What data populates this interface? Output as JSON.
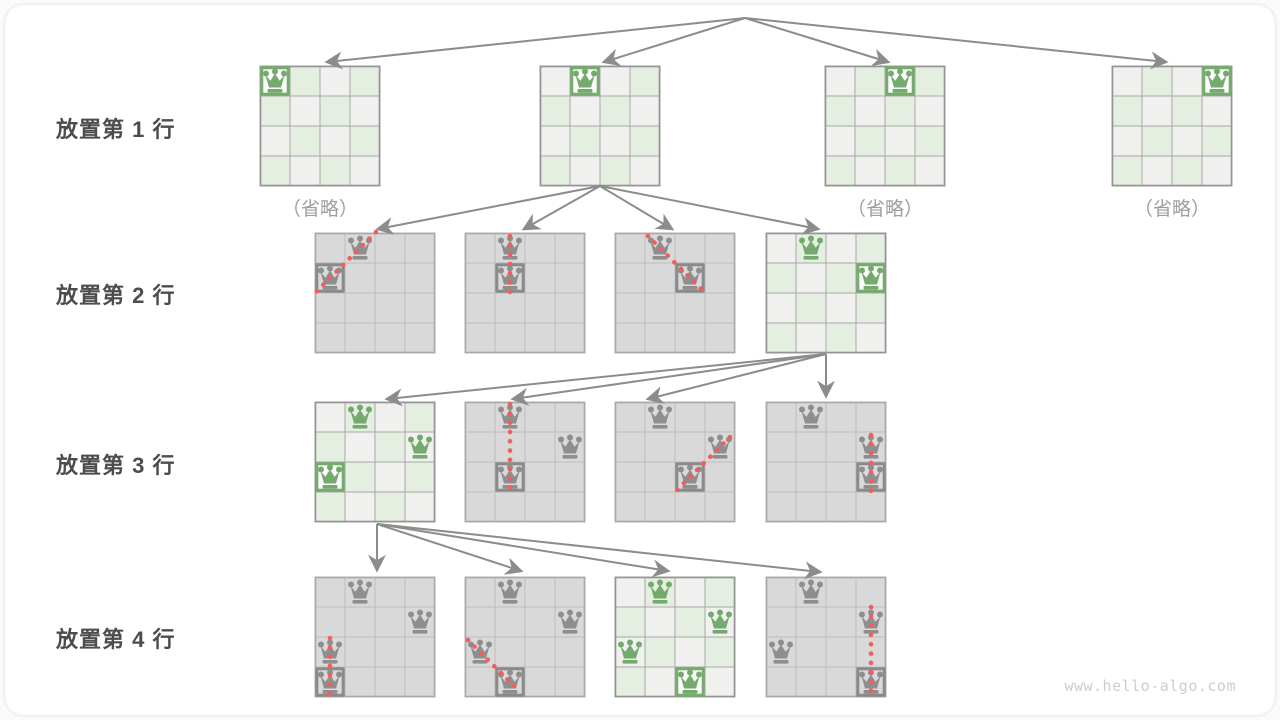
{
  "diagram": {
    "title_semantic": "4-queens backtracking search tree",
    "watermark": "www.hello-algo.com",
    "colors": {
      "queen_green": "#74aa6d",
      "queen_gray": "#8e8e8e",
      "box_green": "#74ac6c",
      "box_gray": "#8a8a8a",
      "box_fill_light": "#fcfcfc",
      "cell_green": "#e4efe1",
      "cell_gray": "#f0f0ef",
      "cell_dark": "#d9d9d9",
      "grid_light": "#a8a8a8",
      "grid_dark": "#bdbdbd",
      "border_light": "#949494",
      "border_dark": "#a9a9a9",
      "arrow": "#8c8c8c",
      "dots": "#f15e5e",
      "label_text": "#4c4c4c",
      "caption_text": "#9e9e9e",
      "watermark_text": "#cdcdcd"
    },
    "cell_size": 30,
    "rows": [
      {
        "label": "放置第 1 行",
        "label_top": 112,
        "boards": [
          {
            "x": 260,
            "y": 66,
            "style": "light",
            "caption": "（省略）",
            "queens": [
              {
                "r": 0,
                "c": 0,
                "color": "green",
                "boxed": true
              }
            ]
          },
          {
            "x": 540,
            "y": 66,
            "style": "light",
            "queens": [
              {
                "r": 0,
                "c": 1,
                "color": "green",
                "boxed": true
              }
            ]
          },
          {
            "x": 825,
            "y": 66,
            "style": "light",
            "caption": "（省略）",
            "queens": [
              {
                "r": 0,
                "c": 2,
                "color": "green",
                "boxed": true
              }
            ]
          },
          {
            "x": 1112,
            "y": 66,
            "style": "light",
            "caption": "（省略）",
            "queens": [
              {
                "r": 0,
                "c": 3,
                "color": "green",
                "boxed": true
              }
            ]
          }
        ]
      },
      {
        "label": "放置第 2 行",
        "label_top": 278,
        "boards": [
          {
            "x": 315,
            "y": 233,
            "style": "gray",
            "queens": [
              {
                "r": 0,
                "c": 1,
                "color": "gray"
              },
              {
                "r": 1,
                "c": 0,
                "color": "gray",
                "boxed": true
              }
            ]
          },
          {
            "x": 465,
            "y": 233,
            "style": "gray",
            "queens": [
              {
                "r": 0,
                "c": 1,
                "color": "gray"
              },
              {
                "r": 1,
                "c": 1,
                "color": "gray",
                "boxed": true
              }
            ]
          },
          {
            "x": 615,
            "y": 233,
            "style": "gray",
            "queens": [
              {
                "r": 0,
                "c": 1,
                "color": "gray"
              },
              {
                "r": 1,
                "c": 2,
                "color": "gray",
                "boxed": true
              }
            ]
          },
          {
            "x": 766,
            "y": 233,
            "style": "light",
            "queens": [
              {
                "r": 0,
                "c": 1,
                "color": "green"
              },
              {
                "r": 1,
                "c": 3,
                "color": "green",
                "boxed": true
              }
            ]
          }
        ]
      },
      {
        "label": "放置第 3 行",
        "label_top": 448,
        "boards": [
          {
            "x": 315,
            "y": 402,
            "style": "light",
            "queens": [
              {
                "r": 0,
                "c": 1,
                "color": "green"
              },
              {
                "r": 1,
                "c": 3,
                "color": "green"
              },
              {
                "r": 2,
                "c": 0,
                "color": "green",
                "boxed": true
              }
            ]
          },
          {
            "x": 465,
            "y": 402,
            "style": "gray",
            "queens": [
              {
                "r": 0,
                "c": 1,
                "color": "gray"
              },
              {
                "r": 1,
                "c": 3,
                "color": "gray"
              },
              {
                "r": 2,
                "c": 1,
                "color": "gray",
                "boxed": true
              }
            ]
          },
          {
            "x": 615,
            "y": 402,
            "style": "gray",
            "queens": [
              {
                "r": 0,
                "c": 1,
                "color": "gray"
              },
              {
                "r": 1,
                "c": 3,
                "color": "gray"
              },
              {
                "r": 2,
                "c": 2,
                "color": "gray",
                "boxed": true
              }
            ]
          },
          {
            "x": 766,
            "y": 402,
            "style": "gray",
            "queens": [
              {
                "r": 0,
                "c": 1,
                "color": "gray"
              },
              {
                "r": 1,
                "c": 3,
                "color": "gray"
              },
              {
                "r": 2,
                "c": 3,
                "color": "gray",
                "boxed": true
              }
            ]
          }
        ]
      },
      {
        "label": "放置第 4 行",
        "label_top": 622,
        "boards": [
          {
            "x": 315,
            "y": 577,
            "style": "gray",
            "queens": [
              {
                "r": 0,
                "c": 1,
                "color": "gray"
              },
              {
                "r": 1,
                "c": 3,
                "color": "gray"
              },
              {
                "r": 2,
                "c": 0,
                "color": "gray"
              },
              {
                "r": 3,
                "c": 0,
                "color": "gray",
                "boxed": true
              }
            ]
          },
          {
            "x": 465,
            "y": 577,
            "style": "gray",
            "queens": [
              {
                "r": 0,
                "c": 1,
                "color": "gray"
              },
              {
                "r": 1,
                "c": 3,
                "color": "gray"
              },
              {
                "r": 2,
                "c": 0,
                "color": "gray"
              },
              {
                "r": 3,
                "c": 1,
                "color": "gray",
                "boxed": true
              }
            ]
          },
          {
            "x": 615,
            "y": 577,
            "style": "light",
            "queens": [
              {
                "r": 0,
                "c": 1,
                "color": "green"
              },
              {
                "r": 1,
                "c": 3,
                "color": "green"
              },
              {
                "r": 2,
                "c": 0,
                "color": "green"
              },
              {
                "r": 3,
                "c": 2,
                "color": "green",
                "boxed": true
              }
            ]
          },
          {
            "x": 766,
            "y": 577,
            "style": "gray",
            "queens": [
              {
                "r": 0,
                "c": 1,
                "color": "gray"
              },
              {
                "r": 1,
                "c": 3,
                "color": "gray"
              },
              {
                "r": 2,
                "c": 0,
                "color": "gray"
              },
              {
                "r": 3,
                "c": 3,
                "color": "gray",
                "boxed": true
              }
            ]
          }
        ]
      }
    ],
    "captions": [
      {
        "bind": "diagram.rows.0.boards.0.caption",
        "left": 240,
        "top": 194
      },
      {
        "bind": "diagram.rows.0.boards.2.caption",
        "left": 805,
        "top": 194
      },
      {
        "bind": "diagram.rows.0.boards.3.caption",
        "left": 1092,
        "top": 194
      }
    ],
    "arrows": [
      {
        "x1": 745,
        "y1": 18,
        "x2": 327,
        "y2": 62
      },
      {
        "x1": 745,
        "y1": 18,
        "x2": 604,
        "y2": 62
      },
      {
        "x1": 745,
        "y1": 18,
        "x2": 888,
        "y2": 62
      },
      {
        "x1": 745,
        "y1": 18,
        "x2": 1166,
        "y2": 62
      },
      {
        "x1": 600,
        "y1": 186,
        "x2": 378,
        "y2": 229
      },
      {
        "x1": 600,
        "y1": 186,
        "x2": 524,
        "y2": 229
      },
      {
        "x1": 600,
        "y1": 186,
        "x2": 672,
        "y2": 229
      },
      {
        "x1": 600,
        "y1": 186,
        "x2": 818,
        "y2": 229
      },
      {
        "x1": 826,
        "y1": 354,
        "x2": 387,
        "y2": 399
      },
      {
        "x1": 826,
        "y1": 354,
        "x2": 513,
        "y2": 399
      },
      {
        "x1": 826,
        "y1": 354,
        "x2": 648,
        "y2": 399
      },
      {
        "x1": 826,
        "y1": 354,
        "x2": 826,
        "y2": 396
      },
      {
        "x1": 377,
        "y1": 524,
        "x2": 377,
        "y2": 570
      },
      {
        "x1": 377,
        "y1": 524,
        "x2": 521,
        "y2": 571
      },
      {
        "x1": 377,
        "y1": 524,
        "x2": 668,
        "y2": 571
      },
      {
        "x1": 377,
        "y1": 524,
        "x2": 820,
        "y2": 572
      }
    ],
    "conflict_lines": [
      {
        "x1": 376,
        "y1": 232,
        "x2": 316,
        "y2": 292
      },
      {
        "x1": 510,
        "y1": 236,
        "x2": 510,
        "y2": 296
      },
      {
        "x1": 648,
        "y1": 236,
        "x2": 702,
        "y2": 290
      },
      {
        "x1": 510,
        "y1": 404,
        "x2": 510,
        "y2": 494
      },
      {
        "x1": 730,
        "y1": 437,
        "x2": 676,
        "y2": 491
      },
      {
        "x1": 871,
        "y1": 435,
        "x2": 871,
        "y2": 495
      },
      {
        "x1": 330,
        "y1": 638,
        "x2": 330,
        "y2": 694
      },
      {
        "x1": 468,
        "y1": 640,
        "x2": 518,
        "y2": 690
      },
      {
        "x1": 871,
        "y1": 607,
        "x2": 871,
        "y2": 695
      }
    ]
  }
}
